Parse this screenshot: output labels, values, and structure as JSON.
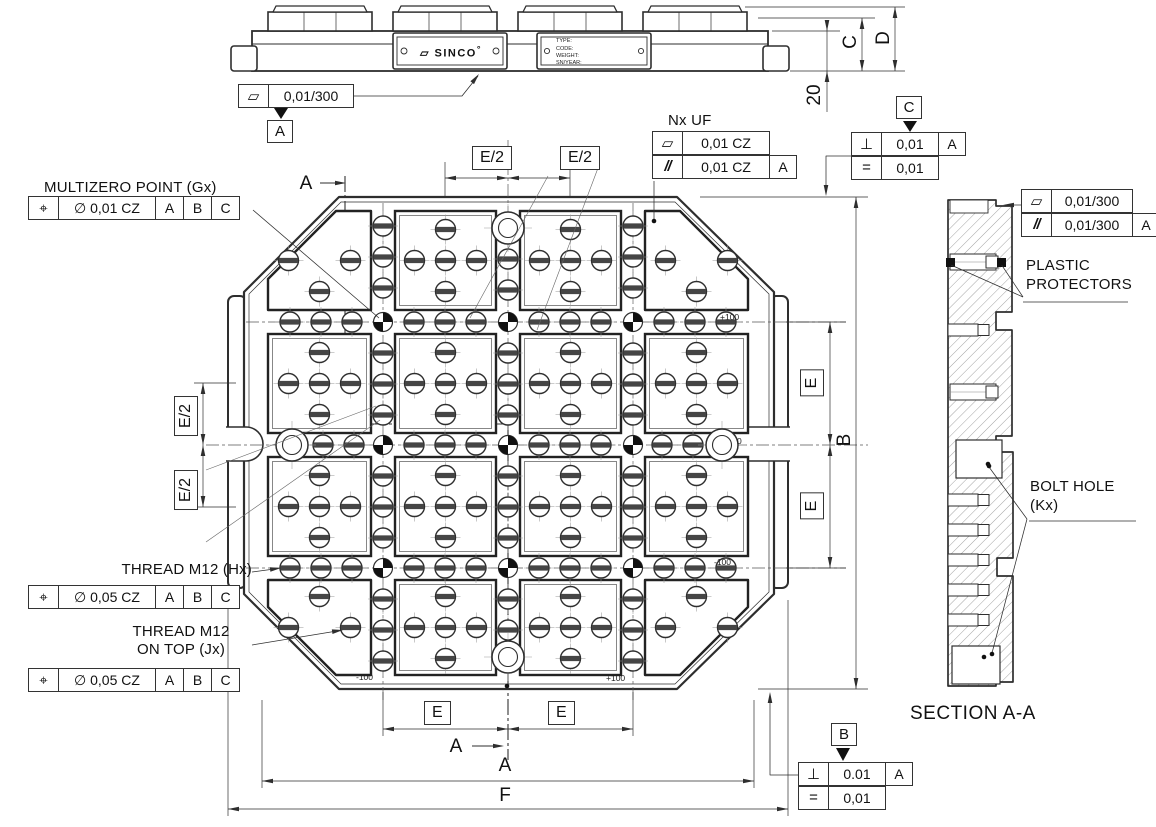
{
  "labels": {
    "multizero": "MULTIZERO POINT (Gx)",
    "thread_hx": "THREAD M12 (Hx)",
    "thread_jx1": "THREAD M12",
    "thread_jx2": "ON TOP (Jx)",
    "nx_uf": "Nx UF",
    "plastic1": "PLASTIC",
    "plastic2": "PROTECTORS",
    "bolt1": "BOLT HOLE",
    "bolt2": "(Kx)",
    "section_title": "SECTION A-A"
  },
  "logo": {
    "icon": "▱",
    "text": "SINCO",
    "mark": "°"
  },
  "nameplate": {
    "type": "TYPE:",
    "code": "CODE:",
    "weight": "WEIGHT:",
    "sn": "SN/YEAR:"
  },
  "datums": {
    "a": "A",
    "b": "B",
    "c": "C"
  },
  "fcf": {
    "g": {
      "sym": "⌖",
      "tol": "∅ 0,01 CZ"
    },
    "h": {
      "sym": "⌖",
      "tol": "∅ 0,05 CZ"
    },
    "j": {
      "sym": "⌖",
      "tol": "∅ 0,05 CZ"
    },
    "elev": {
      "sym": "▱",
      "tol": "0,01/300"
    },
    "nxuf1": {
      "sym": "▱",
      "tol": "0,01 CZ"
    },
    "nxuf2": {
      "sym": "//",
      "tol": "0,01 CZ"
    },
    "c1": {
      "sym": "⊥",
      "tol": "0,01"
    },
    "c2": {
      "sym": "=",
      "tol": "0,01"
    },
    "b1": {
      "sym": "⊥",
      "tol": "0.01"
    },
    "b2": {
      "sym": "=",
      "tol": "0,01"
    },
    "s1": {
      "sym": "▱",
      "tol": "0,01/300"
    },
    "s2": {
      "sym": "//",
      "tol": "0,01/300"
    }
  },
  "dims": {
    "e2": "E/2",
    "e": "E",
    "a": "A",
    "b": "B",
    "c": "C",
    "d": "D",
    "f": "F",
    "t20": "20"
  },
  "coords": {
    "p100": "+100",
    "m100": "-100",
    "zero": "0"
  }
}
